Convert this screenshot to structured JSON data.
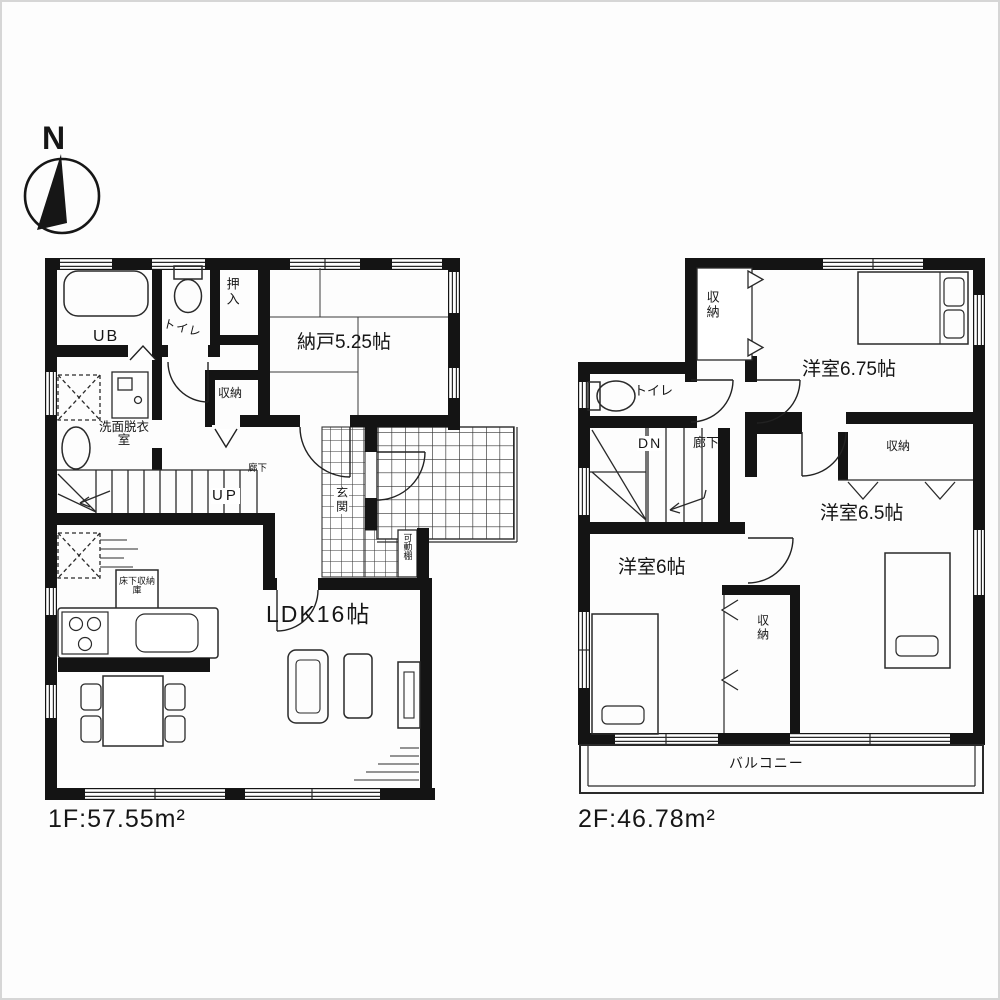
{
  "compass": {
    "north_label": "N"
  },
  "floor1": {
    "area_label": "1F:57.55m²",
    "rooms": {
      "ub": "UB",
      "toilet": "トイレ",
      "oshiire": "押入",
      "nando": "納戸5.25帖",
      "shuno": "収納",
      "senmen": "洗面脱衣室",
      "rouka": "廊下",
      "stairs_up": "UP",
      "genkan": "玄関",
      "kado_dana": "可動棚",
      "yukashita": "床下収納庫",
      "ldk": "LDK16帖"
    }
  },
  "floor2": {
    "area_label": "2F:46.78m²",
    "rooms": {
      "shuno_nw": "収納",
      "yoshitsu_675": "洋室6.75帖",
      "toilet": "トイレ",
      "stairs_dn": "DN",
      "rouka": "廊下",
      "shuno_e": "収納",
      "yoshitsu_65": "洋室6.5帖",
      "yoshitsu_6": "洋室6帖",
      "shuno_s": "収納",
      "balcony": "バルコニー"
    }
  }
}
